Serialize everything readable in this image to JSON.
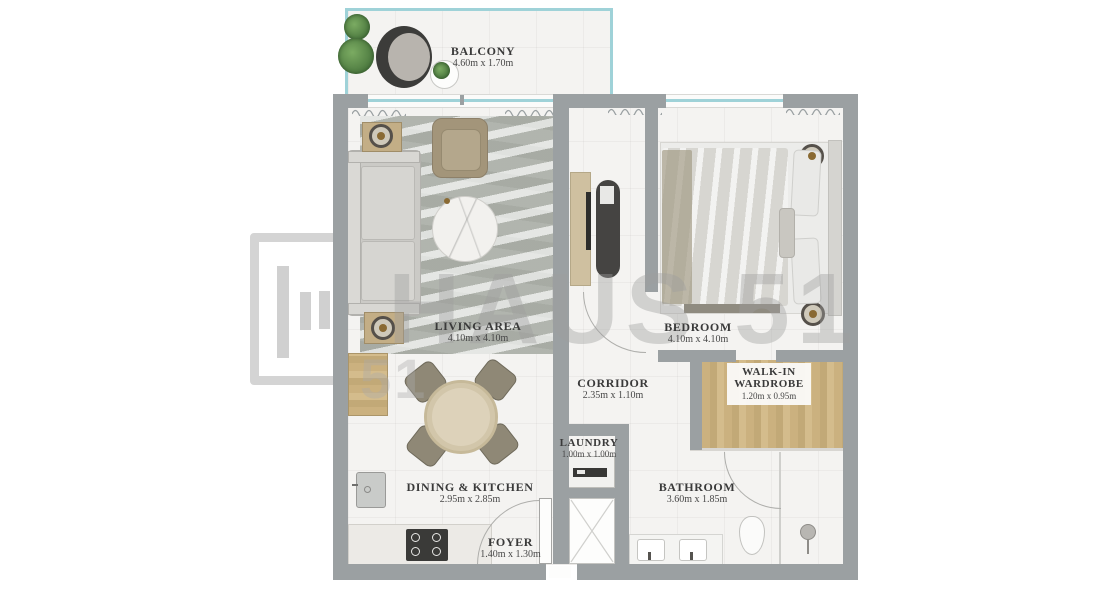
{
  "plan": {
    "rooms": {
      "balcony": {
        "name": "BALCONY",
        "dims": "4.60m x 1.70m"
      },
      "living_area": {
        "name": "LIVING AREA",
        "dims": "4.10m x 4.10m"
      },
      "bedroom": {
        "name": "BEDROOM",
        "dims": "4.10m x 4.10m"
      },
      "corridor": {
        "name": "CORRIDOR",
        "dims": "2.35m x 1.10m"
      },
      "walk_in_wardrobe": {
        "name": "WALK-IN WARDROBE",
        "dims": "1.20m x 0.95m"
      },
      "laundry": {
        "name": "LAUNDRY",
        "dims": "1.00m x 1.00m"
      },
      "dining_kitchen": {
        "name": "DINING & KITCHEN",
        "dims": "2.95m x 2.85m"
      },
      "bathroom": {
        "name": "BATHROOM",
        "dims": "3.60m x 1.85m"
      },
      "foyer": {
        "name": "FOYER",
        "dims": "1.40m x 1.30m"
      }
    }
  },
  "watermark": {
    "brand": "HAUS 51",
    "partial": "51"
  },
  "colors": {
    "wall": "#9ba0a2",
    "glass": "#9fd2d8",
    "wood": "#cbb17f",
    "floor": "#f4f3f1",
    "plant": "#5a8b4c",
    "watermark_gray": "#c7c7c7"
  }
}
